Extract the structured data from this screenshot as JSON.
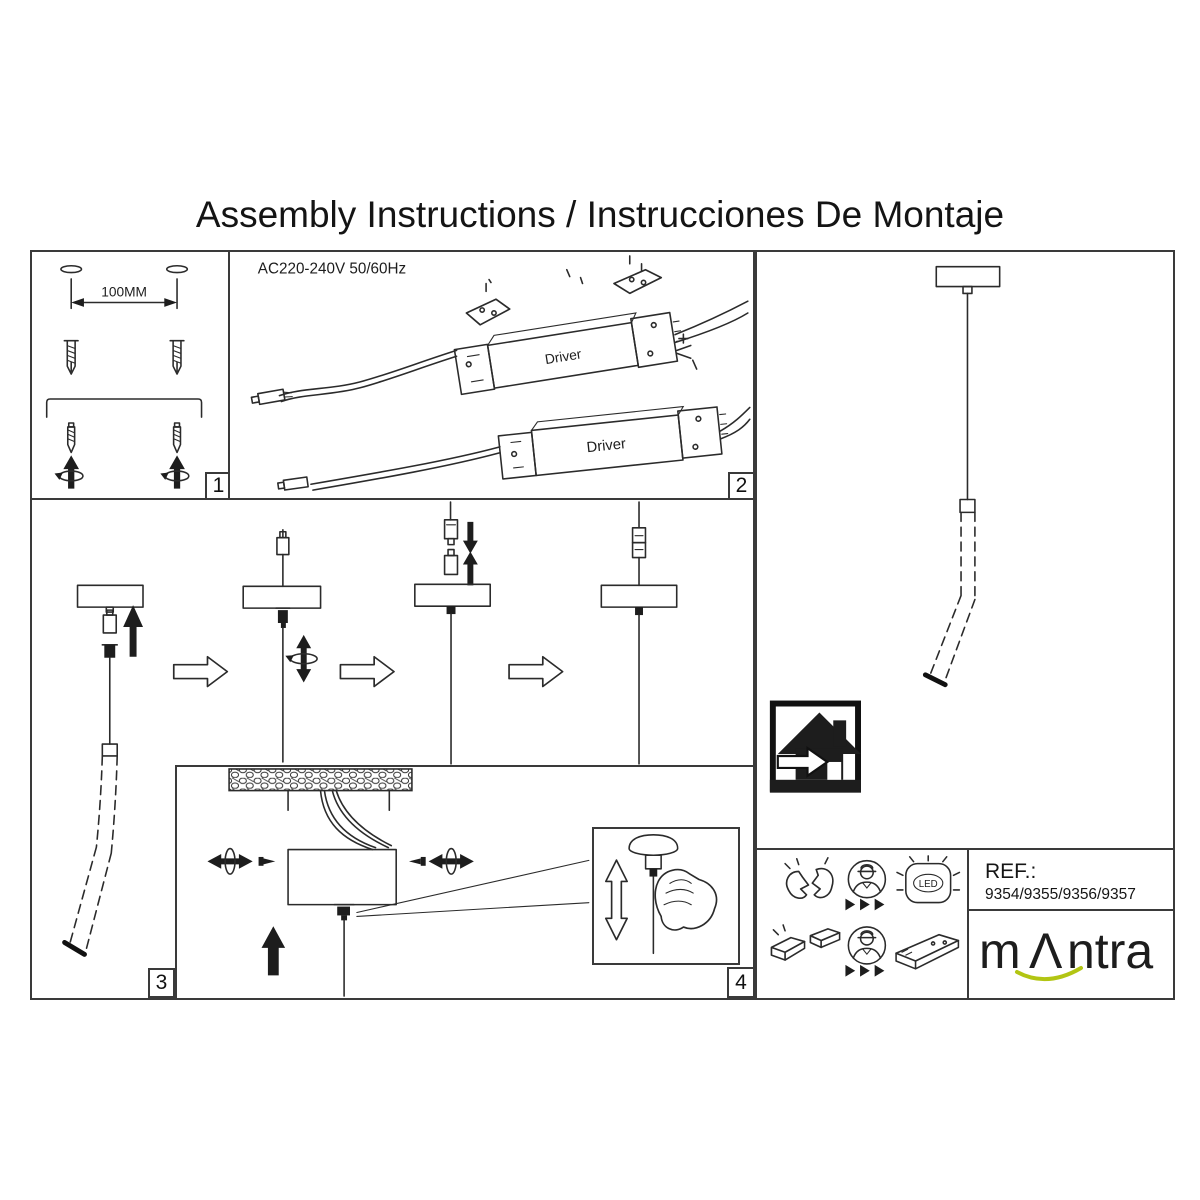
{
  "title": "Assembly Instructions / Instrucciones De Montaje",
  "panels": {
    "mounting": {
      "number": "1",
      "hole_distance": "100MM"
    },
    "wiring": {
      "number": "2",
      "power_rating": "AC220-240V 50/60Hz",
      "driver_label": "Driver"
    },
    "assembly_steps": {
      "number": "3"
    },
    "ceiling_detail": {
      "number": "4"
    }
  },
  "service_icons": {
    "led_label": "LED"
  },
  "reference": {
    "label": "REF.:",
    "models": "9354/9355/9356/9357"
  },
  "brand": {
    "name_start": "m",
    "name_accent_letter": "Λ",
    "name_end": "ntra",
    "accent_color": "#b2c513"
  },
  "colors": {
    "line": "#2b2b2b",
    "background": "#ffffff"
  }
}
